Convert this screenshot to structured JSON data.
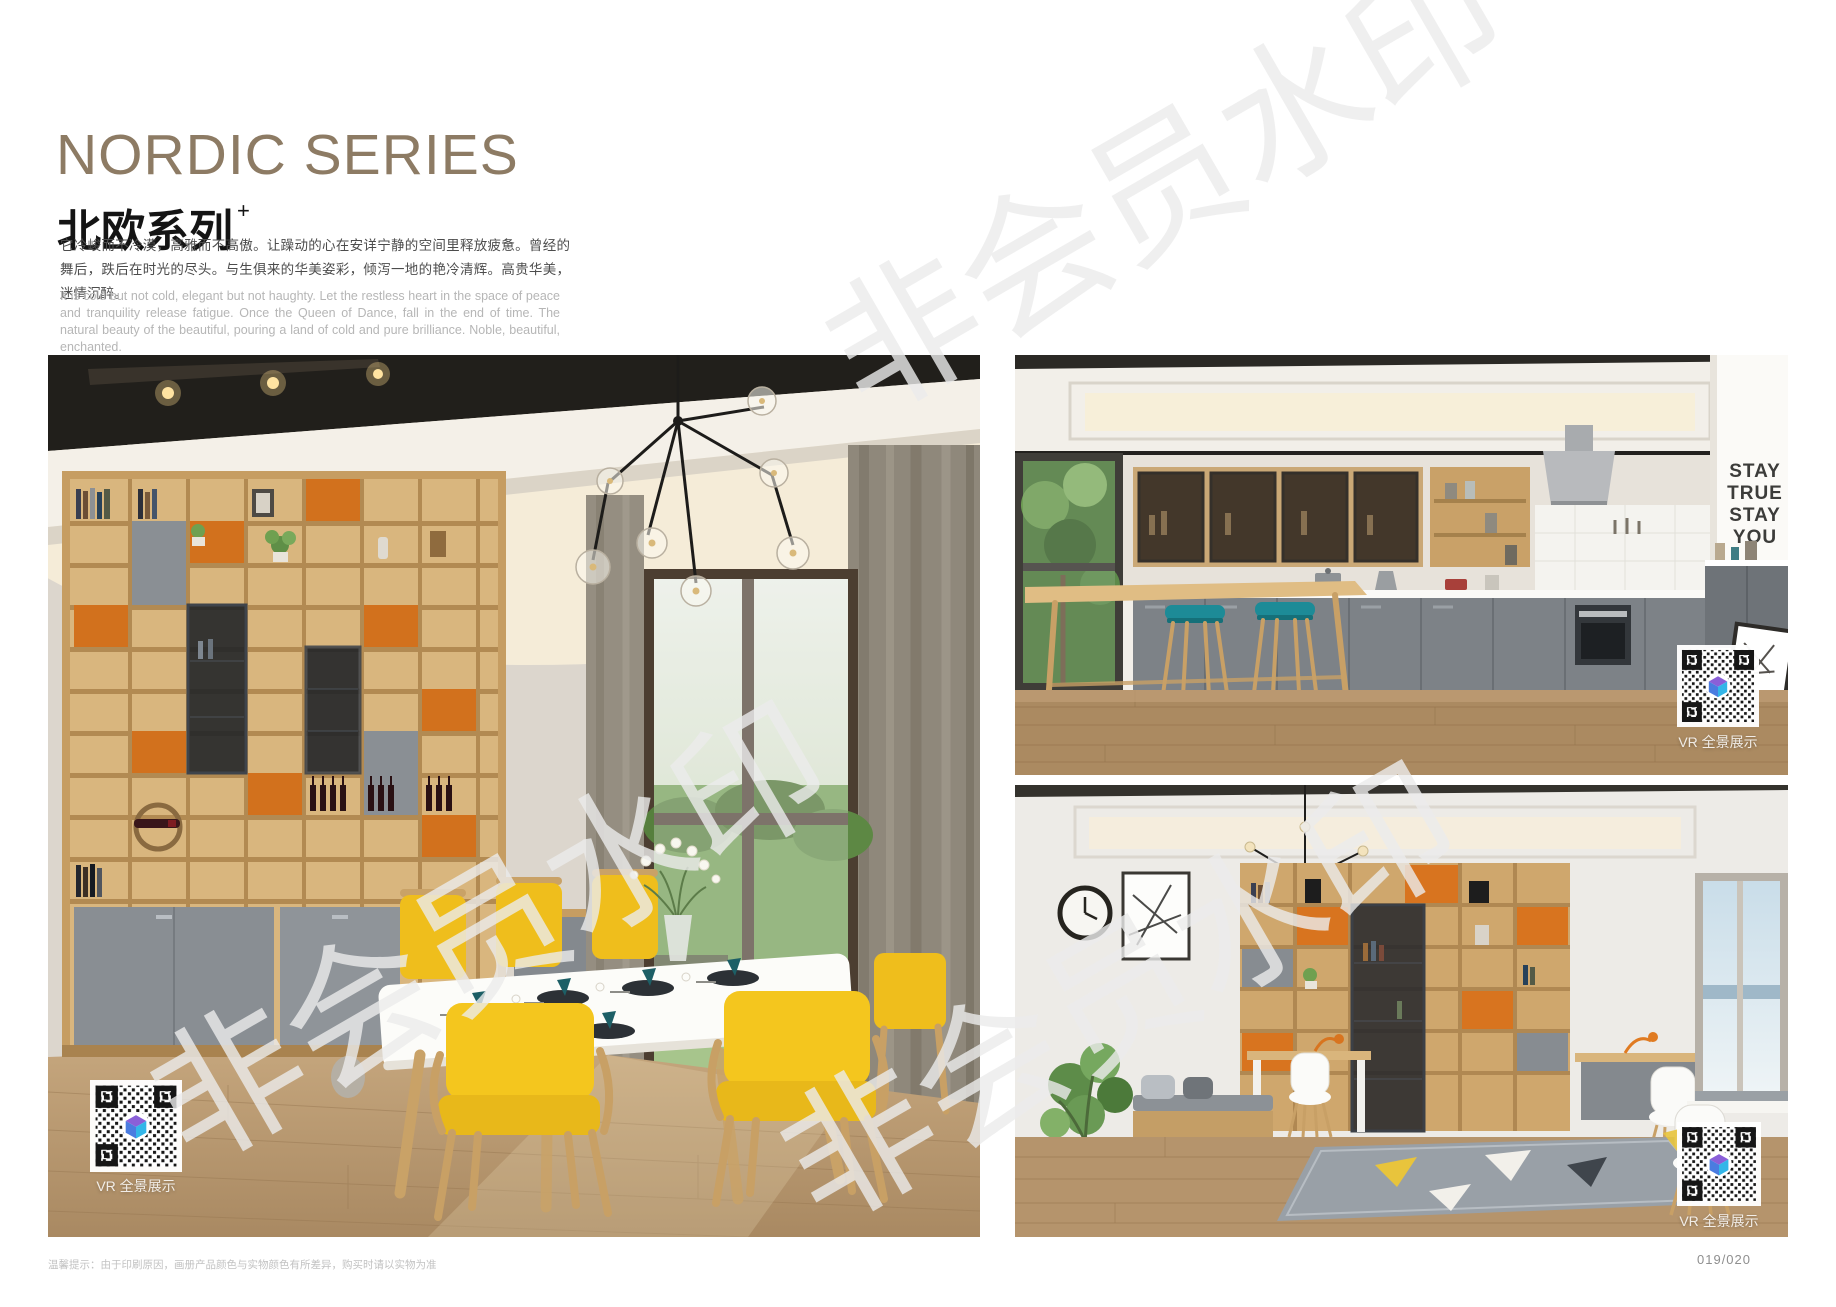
{
  "header": {
    "title_en": "NORDIC SERIES",
    "title_zh": "北欧系列",
    "title_sup": "+",
    "desc_zh": "它冷峻而不冷漠，高雅而不高傲。让躁动的心在安详宁静的空间里释放疲惫。曾经的舞后，跌后在时光的尽头。与生俱来的华美姿彩，倾泻一地的艳冷清辉。高贵华美，迷情沉醉。",
    "desc_en": "It is cold but not cold, elegant but not haughty. Let the restless heart in the space of peace and tranquility release fatigue. Once the Queen of Dance, fall in the end of time. The natural beauty of the beautiful, pouring a land of cold and pure brilliance. Noble, beautiful, enchanted."
  },
  "watermark": {
    "text": "非会员水印"
  },
  "photos": {
    "dining": {
      "vr_label": "VR 全景展示"
    },
    "kitchen": {
      "vr_label": "VR 全景展示",
      "wall_text": [
        "STAY",
        "TRUE",
        "STAY",
        "YOU"
      ]
    },
    "study": {
      "vr_label": "VR 全景展示"
    }
  },
  "footer": {
    "note": "温馨提示：由于印刷原因，画册产品颜色与实物颜色有所差异，购买时请以实物为准",
    "page_number": "019/020"
  },
  "colors": {
    "title_accent": "#8d7b64",
    "chair_yellow": "#f4c61e",
    "cabinet_orange": "#d2711d",
    "stool_teal": "#1d8b97",
    "watermark_gray": "#ececec"
  }
}
